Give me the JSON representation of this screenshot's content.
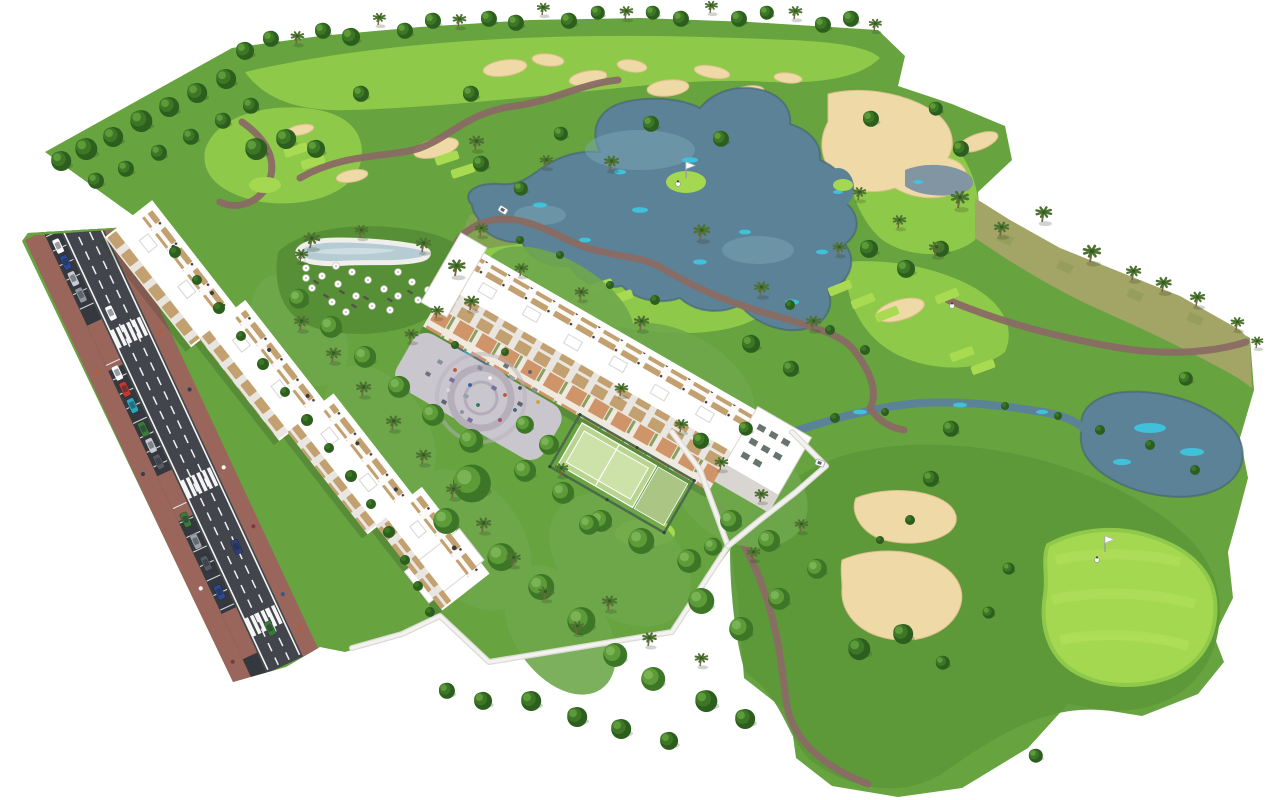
{
  "scene": {
    "type": "aerial-3d-architectural-rendering",
    "setting": "golf-resort-residential-complex",
    "elements": [
      "golf-course-terrain",
      "lakes-and-ponds",
      "water-streams",
      "sand-bunkers",
      "cart-paths",
      "fairways",
      "tee-boxes",
      "putting-green-with-flag",
      "golf-cart",
      "golfers",
      "west-apartment-building-row",
      "central-apartment-building",
      "rooftop-terraces",
      "swimming-pool",
      "pool-lounge-lawn",
      "sun-umbrellas",
      "sun-loungers",
      "central-plaza-playground",
      "playground-equipment",
      "padel-courts",
      "perimeter-walls",
      "access-road",
      "street-parking",
      "crosswalks",
      "parked-cars",
      "moving-cars",
      "sidewalks",
      "pedestrians",
      "palm-trees",
      "deciduous-trees",
      "garden-shrubs",
      "dry-scrub-dunes"
    ]
  },
  "palette": {
    "bg": "#ffffff",
    "grass": "#67a33f",
    "grassDark": "#5d9939",
    "grassDeep": "#568f36",
    "gardenLawn": "#6fa84c",
    "fairway": "#8fc94a",
    "tee": "#a9db52",
    "greenBright": "#a5d851",
    "greenStripe": "#b2e15c",
    "scrub": "#a3a566",
    "scrubDark": "#8c9a55",
    "water": "#5c8297",
    "waterDark": "#455f76",
    "waterGray": "#8195a2",
    "waterLight": "#7ba6b5",
    "cyan": "#3cc8e2",
    "sand": "#eed9a7",
    "sandShade": "#ddc08b",
    "path": "#8a6b64",
    "plaza": "#cac6ce",
    "plazaRing": "#b5afba",
    "plazaDark": "#a39dac",
    "asphalt": "#42464c",
    "asphaltDark": "#35383e",
    "marking": "#ffffff",
    "brick": "#9a655b",
    "building": "#ffffff",
    "facade": "#e9e6e1",
    "facadeDark": "#d9d6d1",
    "wood": "#c3a06f",
    "woodDark": "#ae8a5c",
    "patio": "#cf9468",
    "glass": "#68756d",
    "wall": "#f3f2ef",
    "wallShade": "#dcdad5",
    "fence": "#49684a",
    "padel": "#b9d48e",
    "padelLight": "#cde2a9",
    "courtAlt": "#aac584",
    "treeDark": "#2c5e1e",
    "tree": "#3d7627",
    "treeLight": "#5d9a38",
    "treeLighter": "#79b355",
    "palm": "#4e7231",
    "trunk": "#7a6448",
    "flagPole": "#9aa0a6",
    "shadow": "rgba(40,60,30,0.22)"
  },
  "vegetation": {
    "deciduous": [
      [
        244,
        50,
        9
      ],
      [
        270,
        38,
        8
      ],
      [
        322,
        30,
        8
      ],
      [
        350,
        36,
        9
      ],
      [
        404,
        30,
        8
      ],
      [
        432,
        20,
        8
      ],
      [
        488,
        18,
        8
      ],
      [
        515,
        22,
        8
      ],
      [
        568,
        20,
        8
      ],
      [
        597,
        12,
        7
      ],
      [
        652,
        12,
        7
      ],
      [
        680,
        18,
        8
      ],
      [
        738,
        18,
        8
      ],
      [
        766,
        12,
        7
      ],
      [
        822,
        24,
        8
      ],
      [
        850,
        18,
        8
      ],
      [
        60,
        160,
        10
      ],
      [
        85,
        148,
        11
      ],
      [
        112,
        136,
        10
      ],
      [
        140,
        120,
        11
      ],
      [
        168,
        106,
        10
      ],
      [
        196,
        92,
        10
      ],
      [
        225,
        78,
        10
      ],
      [
        95,
        180,
        8
      ],
      [
        125,
        168,
        8
      ],
      [
        158,
        152,
        8
      ],
      [
        190,
        136,
        8
      ],
      [
        222,
        120,
        8
      ],
      [
        250,
        105,
        8
      ],
      [
        255,
        148,
        11
      ],
      [
        285,
        138,
        10
      ],
      [
        315,
        148,
        9
      ],
      [
        360,
        93,
        8
      ],
      [
        470,
        93,
        8
      ],
      [
        650,
        123,
        8
      ],
      [
        720,
        138,
        8
      ],
      [
        560,
        133,
        7
      ],
      [
        480,
        163,
        8
      ],
      [
        520,
        188,
        7
      ],
      [
        870,
        118,
        8
      ],
      [
        935,
        108,
        7
      ],
      [
        960,
        148,
        8
      ],
      [
        905,
        268,
        9
      ],
      [
        940,
        248,
        8
      ],
      [
        868,
        248,
        9
      ],
      [
        750,
        343,
        9
      ],
      [
        790,
        368,
        8
      ],
      [
        950,
        428,
        8
      ],
      [
        930,
        478,
        8
      ],
      [
        1185,
        378,
        7
      ],
      [
        858,
        648,
        11
      ],
      [
        902,
        633,
        10
      ],
      [
        705,
        700,
        11
      ],
      [
        744,
        718,
        10
      ],
      [
        668,
        740,
        9
      ],
      [
        620,
        728,
        10
      ],
      [
        576,
        716,
        10
      ],
      [
        530,
        700,
        10
      ],
      [
        482,
        700,
        9
      ],
      [
        446,
        690,
        8
      ],
      [
        1008,
        568,
        6
      ],
      [
        988,
        612,
        6
      ],
      [
        942,
        662,
        7
      ],
      [
        1035,
        755,
        7
      ],
      [
        700,
        440,
        8
      ],
      [
        745,
        428,
        7
      ]
    ],
    "palms": [
      [
        296,
        44,
        0.9
      ],
      [
        378,
        25,
        0.85
      ],
      [
        458,
        27,
        0.9
      ],
      [
        542,
        15,
        0.85
      ],
      [
        625,
        19,
        0.9
      ],
      [
        710,
        13,
        0.85
      ],
      [
        794,
        19,
        0.9
      ],
      [
        874,
        31,
        0.85
      ],
      [
        475,
        150,
        1
      ],
      [
        545,
        168,
        0.9
      ],
      [
        610,
        170,
        1
      ],
      [
        700,
        240,
        1.1
      ],
      [
        760,
        296,
        1
      ],
      [
        812,
        330,
        1
      ],
      [
        640,
        330,
        1
      ],
      [
        580,
        300,
        0.9
      ],
      [
        520,
        276,
        0.9
      ],
      [
        480,
        236,
        0.9
      ],
      [
        935,
        256,
        1
      ],
      [
        898,
        228,
        0.9
      ],
      [
        858,
        200,
        0.9
      ],
      [
        838,
        255,
        0.9
      ],
      [
        958,
        208,
        1.2
      ],
      [
        1000,
        236,
        1
      ],
      [
        1042,
        222,
        1.1
      ],
      [
        1090,
        262,
        1.2
      ],
      [
        1132,
        280,
        1
      ],
      [
        1162,
        292,
        1.05
      ],
      [
        1196,
        306,
        1
      ],
      [
        1236,
        330,
        0.9
      ],
      [
        1256,
        348,
        0.8
      ],
      [
        310,
        248,
        1.1
      ],
      [
        360,
        238,
        0.9
      ],
      [
        422,
        252,
        1
      ],
      [
        455,
        276,
        1.15
      ],
      [
        470,
        310,
        1
      ],
      [
        300,
        262,
        0.9
      ],
      [
        410,
        342,
        0.9
      ],
      [
        436,
        318,
        0.85
      ],
      [
        300,
        330,
        1
      ],
      [
        332,
        362,
        1
      ],
      [
        362,
        396,
        1
      ],
      [
        392,
        430,
        1
      ],
      [
        422,
        464,
        1
      ],
      [
        452,
        498,
        1
      ],
      [
        482,
        532,
        1
      ],
      [
        512,
        566,
        0.95
      ],
      [
        544,
        600,
        0.95
      ],
      [
        576,
        634,
        0.9
      ],
      [
        620,
        396,
        0.9
      ],
      [
        680,
        432,
        0.9
      ],
      [
        720,
        470,
        0.9
      ],
      [
        760,
        502,
        0.9
      ],
      [
        608,
        610,
        1
      ],
      [
        648,
        646,
        0.95
      ],
      [
        700,
        666,
        0.9
      ],
      [
        560,
        476,
        0.9
      ],
      [
        752,
        560,
        0.9
      ],
      [
        800,
        532,
        0.9
      ]
    ],
    "garden_trees": [
      [
        470,
        482,
        19
      ],
      [
        445,
        520,
        13
      ],
      [
        500,
        556,
        14
      ],
      [
        540,
        586,
        13
      ],
      [
        580,
        620,
        14
      ],
      [
        614,
        654,
        12
      ],
      [
        652,
        678,
        12
      ],
      [
        640,
        540,
        13
      ],
      [
        688,
        560,
        12
      ],
      [
        730,
        520,
        11
      ],
      [
        768,
        540,
        11
      ],
      [
        700,
        600,
        13
      ],
      [
        740,
        628,
        12
      ],
      [
        778,
        598,
        11
      ],
      [
        816,
        568,
        10
      ],
      [
        600,
        520,
        11
      ],
      [
        562,
        492,
        11
      ],
      [
        524,
        470,
        11
      ],
      [
        588,
        524,
        10
      ],
      [
        712,
        546,
        9
      ],
      [
        470,
        440,
        12
      ],
      [
        432,
        414,
        11
      ],
      [
        398,
        386,
        11
      ],
      [
        364,
        356,
        11
      ],
      [
        330,
        326,
        11
      ],
      [
        298,
        298,
        10
      ],
      [
        548,
        444,
        10
      ],
      [
        524,
        424,
        9
      ]
    ],
    "bushes": [
      [
        835,
        418,
        5
      ],
      [
        885,
        412,
        4
      ],
      [
        1005,
        406,
        4
      ],
      [
        1058,
        416,
        4
      ],
      [
        655,
        300,
        5
      ],
      [
        610,
        285,
        4
      ],
      [
        560,
        255,
        4
      ],
      [
        520,
        240,
        4
      ],
      [
        790,
        305,
        5
      ],
      [
        830,
        330,
        5
      ],
      [
        865,
        350,
        5
      ],
      [
        455,
        345,
        4
      ],
      [
        505,
        352,
        4
      ],
      [
        1100,
        430,
        5
      ],
      [
        1150,
        445,
        5
      ],
      [
        1195,
        470,
        5
      ],
      [
        910,
        520,
        5
      ],
      [
        880,
        540,
        4
      ],
      [
        175,
        252,
        6
      ],
      [
        197,
        280,
        5
      ],
      [
        219,
        308,
        6
      ],
      [
        241,
        336,
        5
      ],
      [
        263,
        364,
        6
      ],
      [
        285,
        392,
        5
      ],
      [
        307,
        420,
        6
      ],
      [
        329,
        448,
        5
      ],
      [
        351,
        476,
        6
      ],
      [
        371,
        504,
        5
      ],
      [
        389,
        532,
        6
      ],
      [
        405,
        560,
        5
      ],
      [
        418,
        586,
        5
      ],
      [
        430,
        612,
        5
      ]
    ]
  },
  "road": {
    "crosswalk_positions": [
      118,
      284,
      436
    ],
    "bay_zones": [
      [
        6,
        100
      ],
      [
        148,
        266
      ],
      [
        306,
        426
      ]
    ],
    "bay_step": 16,
    "parked_cars": [
      [
        12,
        "#ffffff"
      ],
      [
        30,
        "#2c4a8f"
      ],
      [
        48,
        "#c9ccd1"
      ],
      [
        66,
        "#8e959c"
      ],
      [
        152,
        "#ffffff"
      ],
      [
        170,
        "#c03a30"
      ],
      [
        188,
        "#2aa7b8"
      ],
      [
        214,
        "#3c7a3a"
      ],
      [
        232,
        "#c9ccd1"
      ],
      [
        250,
        "#565b63"
      ],
      [
        314,
        "#3c7a3a"
      ],
      [
        338,
        "#9aa0a6"
      ],
      [
        362,
        "#565b63"
      ],
      [
        394,
        "#2c4a8f"
      ]
    ],
    "moving_cars": [
      [
        95,
        47,
        "#ffffff"
      ],
      [
        360,
        62,
        "#2f3f7a"
      ],
      [
        448,
        58,
        "#3c7a3a"
      ]
    ],
    "pedestrians_outer": [
      [
        150,
        10
      ],
      [
        262,
        8
      ],
      [
        390,
        12
      ],
      [
        470,
        10
      ]
    ],
    "pedestrians_inner": [
      [
        80,
        86
      ],
      [
        140,
        84
      ],
      [
        205,
        86
      ],
      [
        290,
        84
      ],
      [
        356,
        86
      ],
      [
        430,
        84
      ],
      [
        468,
        86
      ]
    ],
    "ped_colors": [
      "#b85c33",
      "#394049",
      "#ffffff",
      "#803a3a",
      "#2f5d8a"
    ]
  },
  "golf": {
    "tee_boxes": [
      [
        296,
        150,
        -18
      ],
      [
        313,
        162,
        -18
      ],
      [
        447,
        158,
        -18
      ],
      [
        463,
        171,
        -18
      ],
      [
        601,
        286,
        -18
      ],
      [
        621,
        297,
        -18
      ],
      [
        840,
        288,
        -22
      ],
      [
        863,
        301,
        -22
      ],
      [
        887,
        314,
        -22
      ],
      [
        947,
        296,
        -22
      ],
      [
        962,
        354,
        -20
      ],
      [
        983,
        367,
        -20
      ],
      [
        520,
        294,
        -18
      ]
    ],
    "flags": [
      [
        1105,
        552
      ],
      [
        686,
        178
      ]
    ],
    "golfers": [
      [
        1097,
        560
      ],
      [
        678,
        184
      ],
      [
        952,
        306
      ]
    ],
    "carts": [
      [
        820,
        463,
        20
      ],
      [
        503,
        210,
        32
      ]
    ]
  },
  "pool": {
    "umbrellas": [
      [
        306,
        268
      ],
      [
        322,
        276
      ],
      [
        338,
        284
      ],
      [
        312,
        288
      ],
      [
        352,
        272
      ],
      [
        368,
        280
      ],
      [
        384,
        289
      ],
      [
        356,
        296
      ],
      [
        332,
        302
      ],
      [
        398,
        272
      ],
      [
        412,
        282
      ],
      [
        398,
        296
      ],
      [
        372,
        306
      ],
      [
        346,
        312
      ],
      [
        418,
        300
      ],
      [
        306,
        278
      ],
      [
        428,
        290
      ],
      [
        390,
        310
      ],
      [
        302,
        258
      ],
      [
        336,
        266
      ]
    ],
    "loungers": [
      [
        316,
        282
      ],
      [
        342,
        292
      ],
      [
        366,
        298
      ],
      [
        390,
        300
      ],
      [
        410,
        292
      ],
      [
        326,
        296
      ],
      [
        354,
        306
      ]
    ]
  },
  "plaza": {
    "equipment": [
      [
        440,
        362,
        "#8a8f99"
      ],
      [
        452,
        380,
        "#7a6fa0"
      ],
      [
        466,
        396,
        "#9aa0ab"
      ],
      [
        444,
        402,
        "#5f6570"
      ],
      [
        480,
        368,
        "#8a8f99"
      ],
      [
        494,
        388,
        "#7a6fa0"
      ],
      [
        512,
        378,
        "#9aa0ab"
      ],
      [
        520,
        404,
        "#5f6570"
      ],
      [
        535,
        390,
        "#8a8f99"
      ],
      [
        470,
        420,
        "#7a6fa0"
      ],
      [
        428,
        374,
        "#6b7280"
      ],
      [
        506,
        366,
        "#6b7280"
      ]
    ],
    "people": [
      [
        455,
        370,
        "#c0533c"
      ],
      [
        470,
        385,
        "#3a5a9c"
      ],
      [
        490,
        378,
        "#f5f5f5"
      ],
      [
        505,
        395,
        "#c0533c"
      ],
      [
        520,
        388,
        "#454b54"
      ],
      [
        478,
        405,
        "#2e7d4f"
      ],
      [
        538,
        402,
        "#c9a23a"
      ],
      [
        462,
        412,
        "#8a8f98"
      ],
      [
        500,
        420,
        "#a84a74"
      ],
      [
        530,
        372,
        "#5a6270"
      ],
      [
        448,
        390,
        "#d9d9d9"
      ],
      [
        515,
        410,
        "#39647f"
      ]
    ]
  }
}
